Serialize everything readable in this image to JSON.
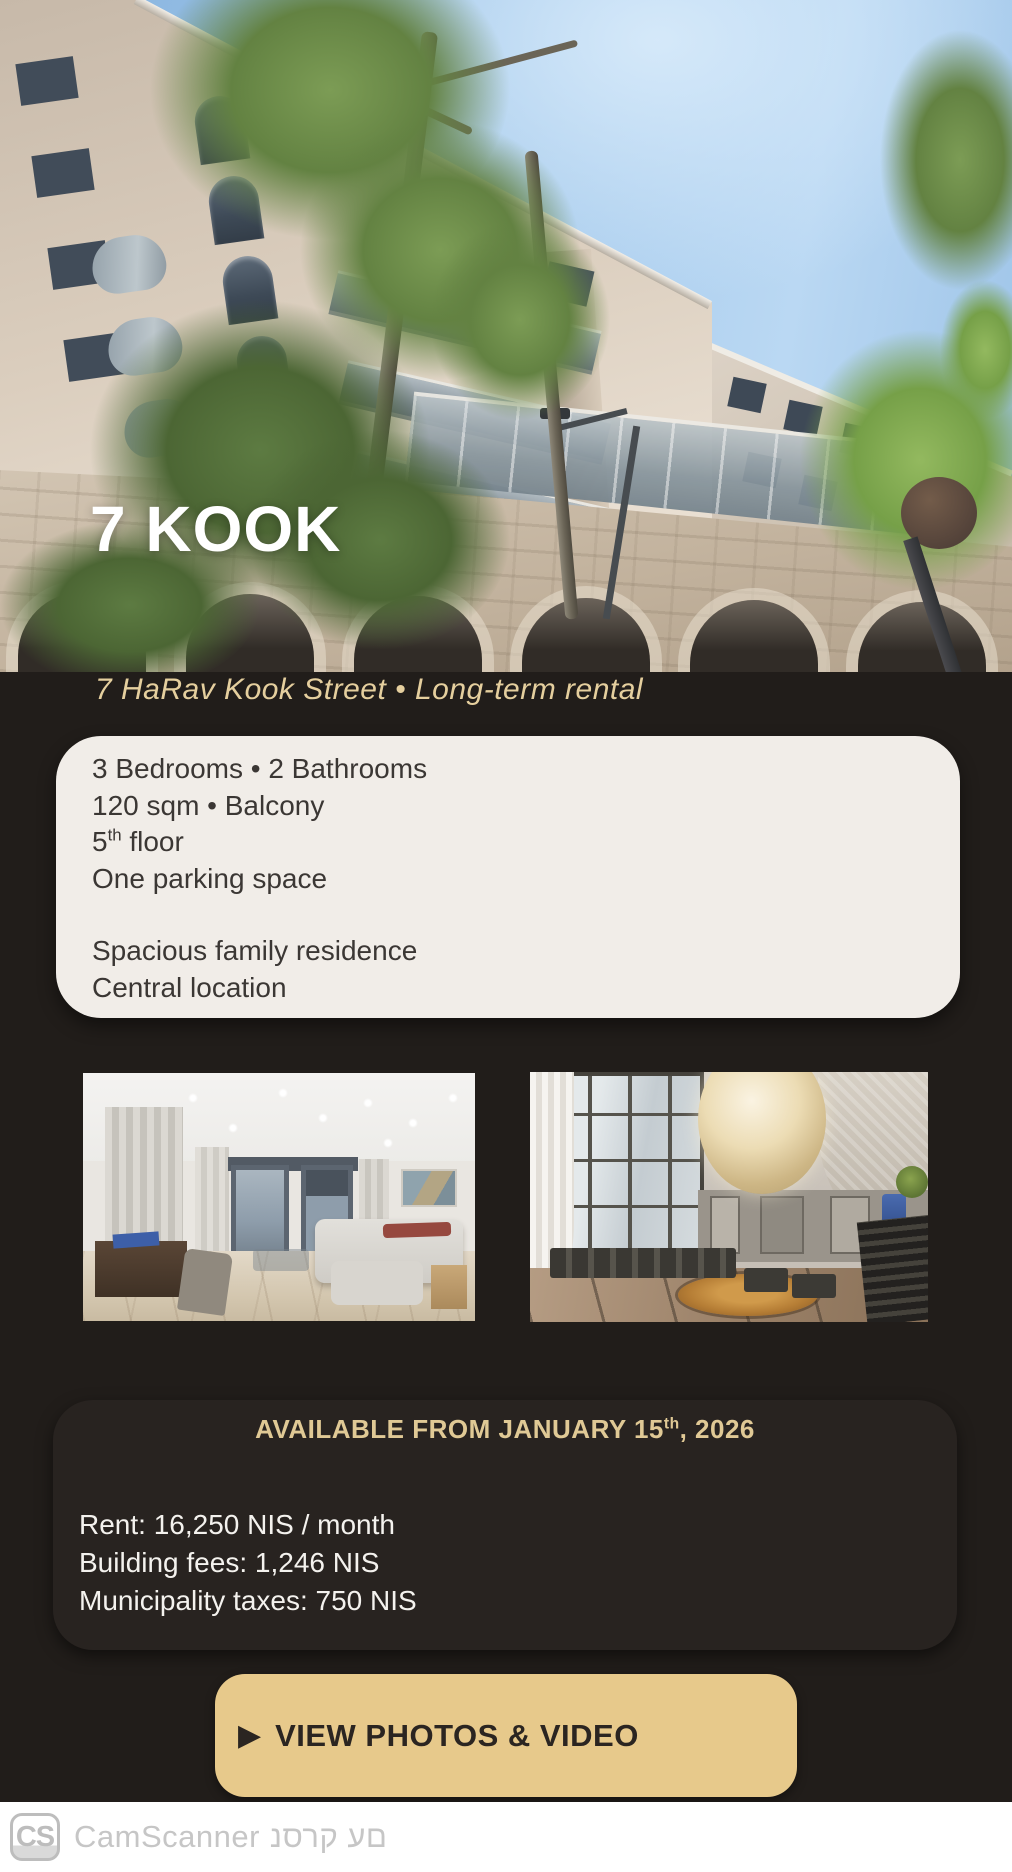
{
  "colors": {
    "page_background": "#211d1a",
    "gold_accent": "#e5cf9e",
    "button_gold": "#e7c98b",
    "card_cream": "#f1ede8"
  },
  "hero": {
    "title": "7 KOOK"
  },
  "subtitle": "7 HaRav Kook Street • Long-term rental",
  "details_card": {
    "line1": "3 Bedrooms • 2 Bathrooms",
    "line2": "120 sqm • Balcony",
    "line3_number": "5",
    "line3_sup": "th",
    "line3_rest": " floor",
    "line4": "One parking space",
    "line5": "Spacious family residence",
    "line6": "Central location"
  },
  "availability_card": {
    "heading_main": "AVAILABLE FROM JANUARY 15",
    "heading_sup": "th",
    "heading_tail": ", 2026",
    "rent": "Rent: 16,250 NIS / month",
    "building_fees": "Building fees: 1,246 NIS",
    "municipality_taxes": "Municipality taxes: 750 NIS"
  },
  "cta_button": {
    "icon": "▶",
    "label": "VIEW PHOTOS & VIDEO"
  },
  "footer": {
    "logo": "CS",
    "brand": "CamScanner",
    "hebrew_text": "נסרק עם"
  }
}
